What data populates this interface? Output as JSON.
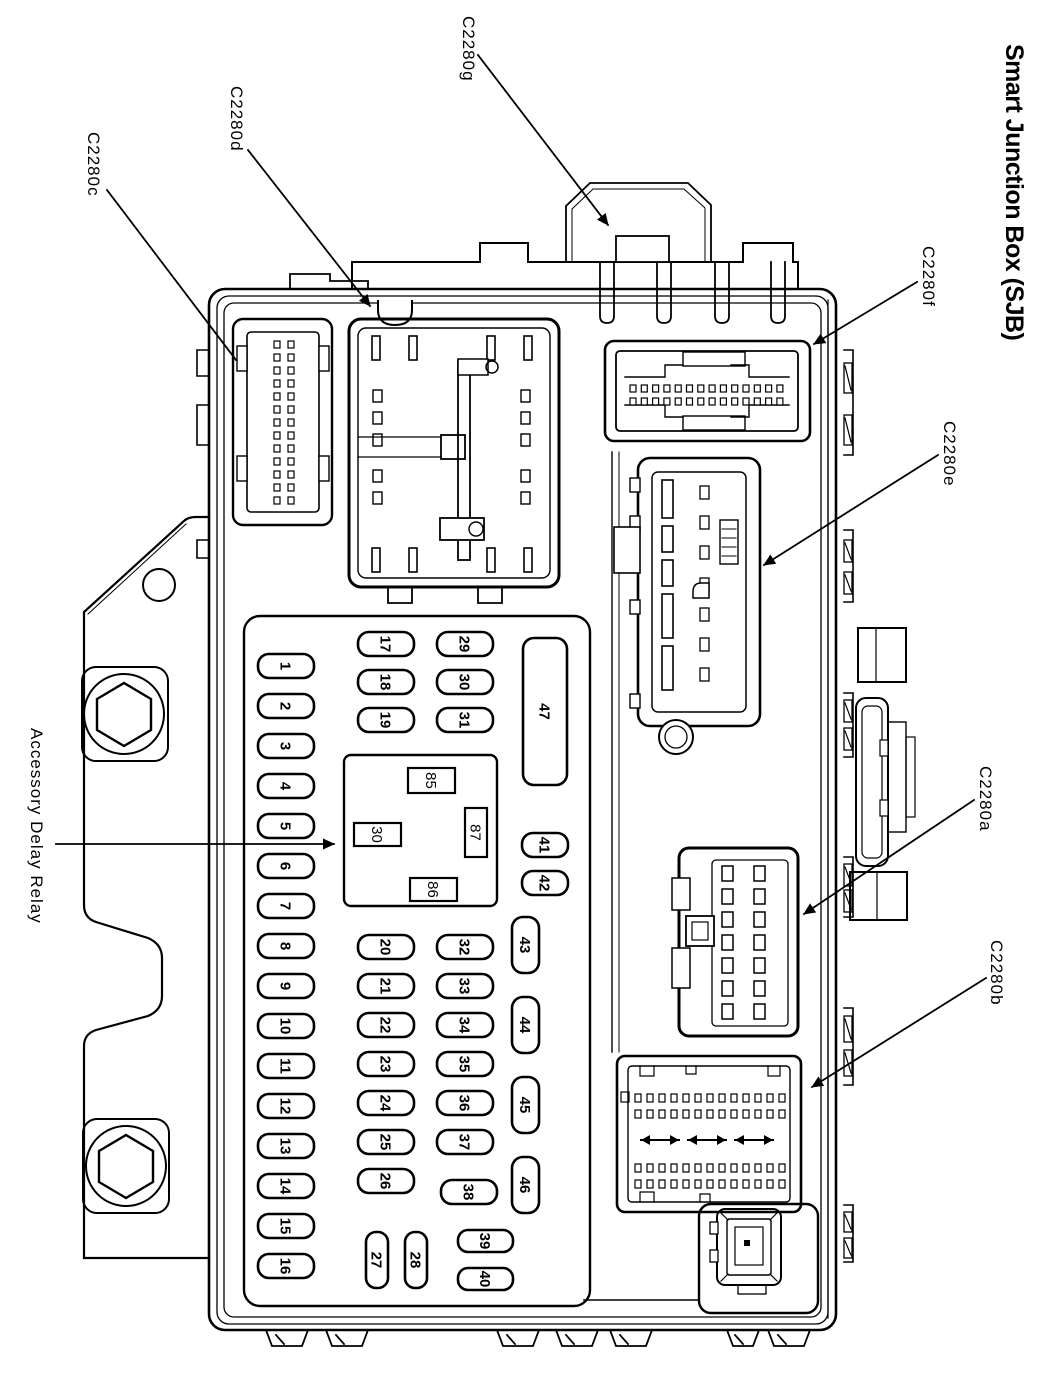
{
  "title": "Smart Junction Box (SJB)",
  "callouts": {
    "c2280c": "C2280c",
    "c2280d": "C2280d",
    "c2280g": "C2280g",
    "c2280f": "C2280f",
    "c2280e": "C2280e",
    "c2280a": "C2280a",
    "c2280b": "C2280b",
    "accessory_delay_relay": "Accessory Delay Relay"
  },
  "fusebox": {
    "fuse_labels": [
      "1",
      "2",
      "3",
      "4",
      "5",
      "6",
      "7",
      "8",
      "9",
      "10",
      "11",
      "12",
      "13",
      "14",
      "15",
      "16",
      "17",
      "18",
      "19",
      "20",
      "21",
      "22",
      "23",
      "24",
      "25",
      "26",
      "27",
      "28",
      "29",
      "30",
      "31",
      "32",
      "33",
      "34",
      "35",
      "36",
      "37",
      "38",
      "39",
      "40",
      "47",
      "41",
      "42",
      "43",
      "44",
      "45",
      "46"
    ],
    "relay_pin_labels": [
      "85",
      "30",
      "87",
      "86"
    ]
  },
  "colors": {
    "ink": "#000000",
    "paper": "#ffffff"
  }
}
